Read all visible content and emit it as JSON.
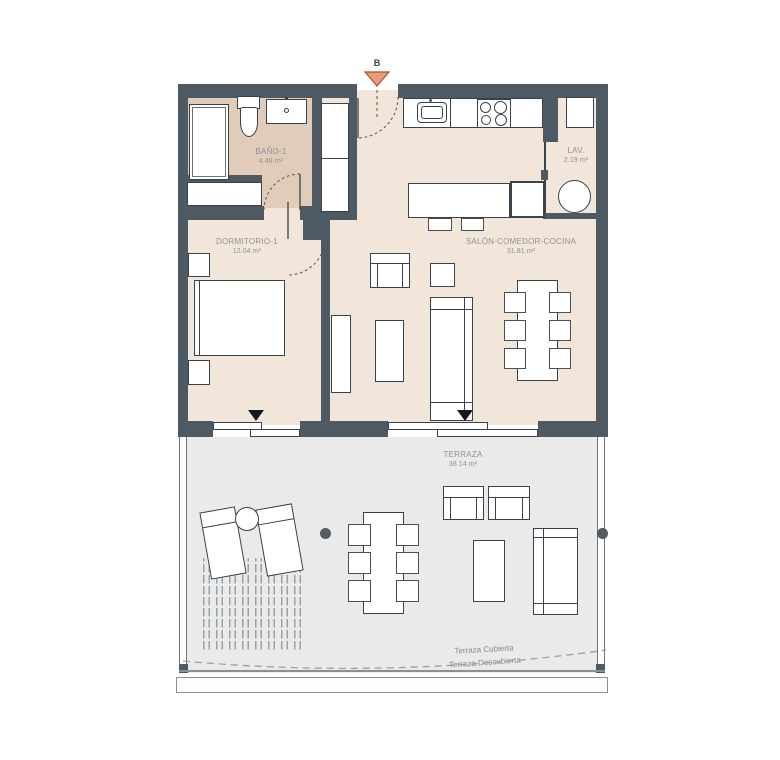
{
  "section_marker": {
    "label": "B"
  },
  "rooms": {
    "bathroom": {
      "name": "BAÑO-1",
      "area": "4.48 m²"
    },
    "bedroom": {
      "name": "DORMITORIO-1",
      "area": "12.04 m²"
    },
    "living": {
      "name": "SALÓN-COMEDOR-COCINA",
      "area": "31.81 m²"
    },
    "laundry": {
      "name": "LAV.",
      "area": "2.19 m²"
    },
    "terrace": {
      "name": "TERRAZA",
      "area": "38.14 m²"
    }
  },
  "terrace_zones": {
    "covered": "Terraza Cubierta",
    "uncovered": "Terraza Descubierta"
  },
  "colors": {
    "wall": "#4d5a64",
    "wall_dark": "#39444d",
    "floor": "#f2e6da",
    "bathroom_floor": "#e1ccba",
    "terrace_floor": "#e9eae9",
    "outline": "#3a414a",
    "label_text": "#8d9296",
    "zone_text": "#85898d",
    "marker_fill": "#e89b78",
    "marker_border": "#9c5a33",
    "hatch": "#99a1a7",
    "accent_dot": "#545c63"
  }
}
